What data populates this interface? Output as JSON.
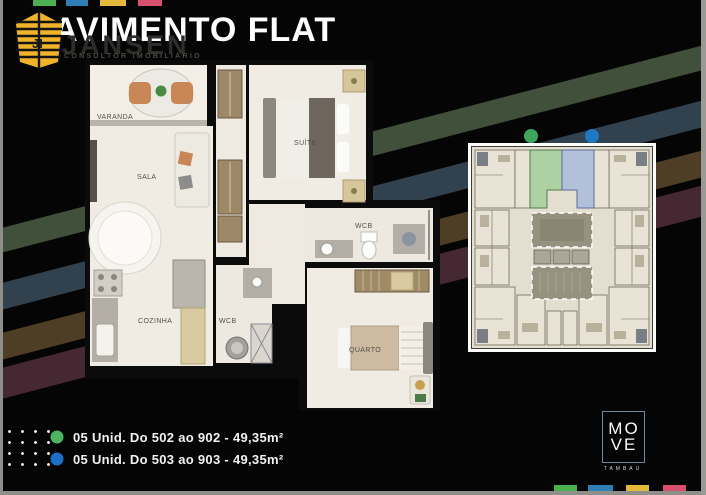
{
  "header": {
    "title": "AVIMENTO FLAT",
    "brand": "JANSEN",
    "brand_tagline": "CONSULTOR IMOBILIÁRIO"
  },
  "floor_plan": {
    "varanda": "VARANDA",
    "sala": "SALA",
    "suite": "SUÍTE",
    "wcb_suite": "WCB",
    "cozinha": "COZINHA",
    "wcb_social": "WCB",
    "quarto": "QUARTO"
  },
  "key_plan": {
    "unit_green_color": "#3fa45f",
    "unit_blue_color": "#1e78c4",
    "green_unit_fill": "#a8cf9f",
    "blue_unit_fill": "#aebdda"
  },
  "legend": {
    "item1": {
      "dot_color": "#4db561",
      "text": "05 Unid. Do 502 ao 902 - 49,35m²"
    },
    "item2": {
      "dot_color": "#1e6fc4",
      "text": "05 Unid. Do 503 ao 903 - 49,35m²"
    }
  },
  "footer_brand": {
    "line1": "MO",
    "line2": "VE",
    "sub": "TAMBAU"
  },
  "accents": {
    "square_green": "#4caf50",
    "square_blue": "#2e7fb5",
    "square_yellow": "#e2b93b",
    "square_pink": "#d94f6e",
    "stripe_green": "#41503a",
    "stripe_blue": "#32414e",
    "stripe_olive": "#4e3e26",
    "stripe_maroon": "#462832",
    "logo_yellow": "#f0b32a"
  }
}
